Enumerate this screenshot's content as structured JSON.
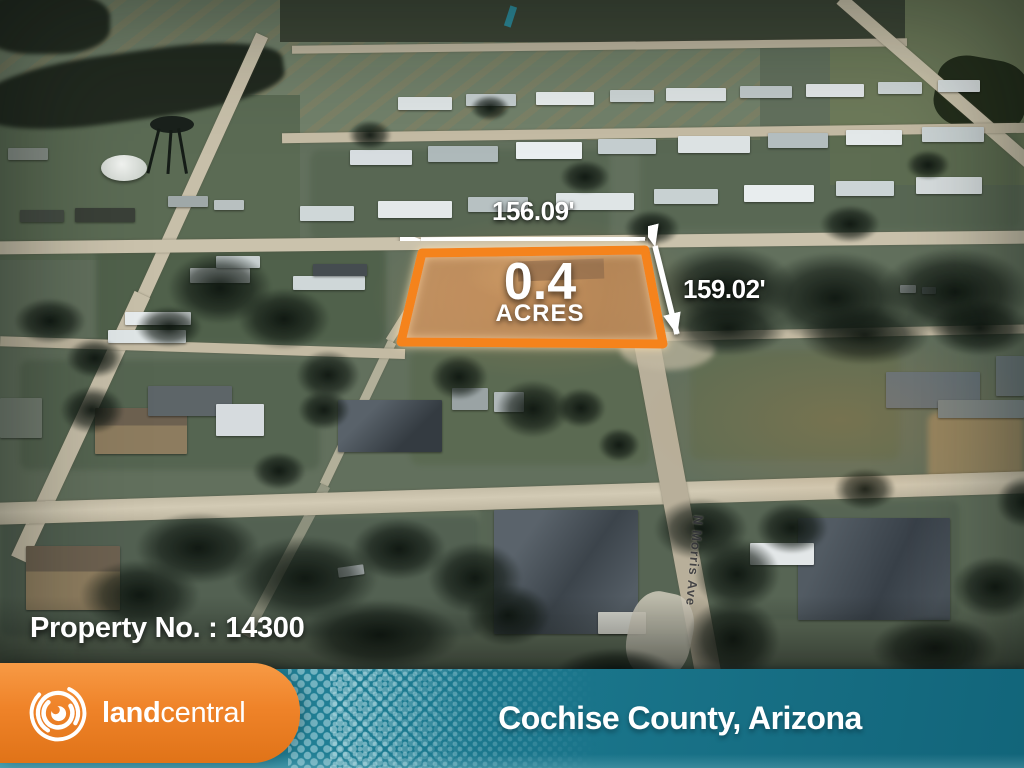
{
  "colors": {
    "brand-orange": "#EF8329",
    "brand-orange-light": "#F79A45",
    "brand-orange-deep": "#E07318",
    "brand-teal": "#1D7B91",
    "brand-teal-light": "#3494A8",
    "brand-teal-dark": "#12657A",
    "parcel-orange": "#F5831D"
  },
  "parcel": {
    "acres_value": "0.4",
    "acres_unit": "ACRES",
    "width_dimension": "156.09'",
    "depth_dimension": "159.02'"
  },
  "annotations": {
    "property_label": "Property No. : 14300"
  },
  "map": {
    "street_name": "N Morris Ave"
  },
  "footer": {
    "brand_land": "land",
    "brand_central": "central",
    "location": "Cochise County, Arizona"
  }
}
